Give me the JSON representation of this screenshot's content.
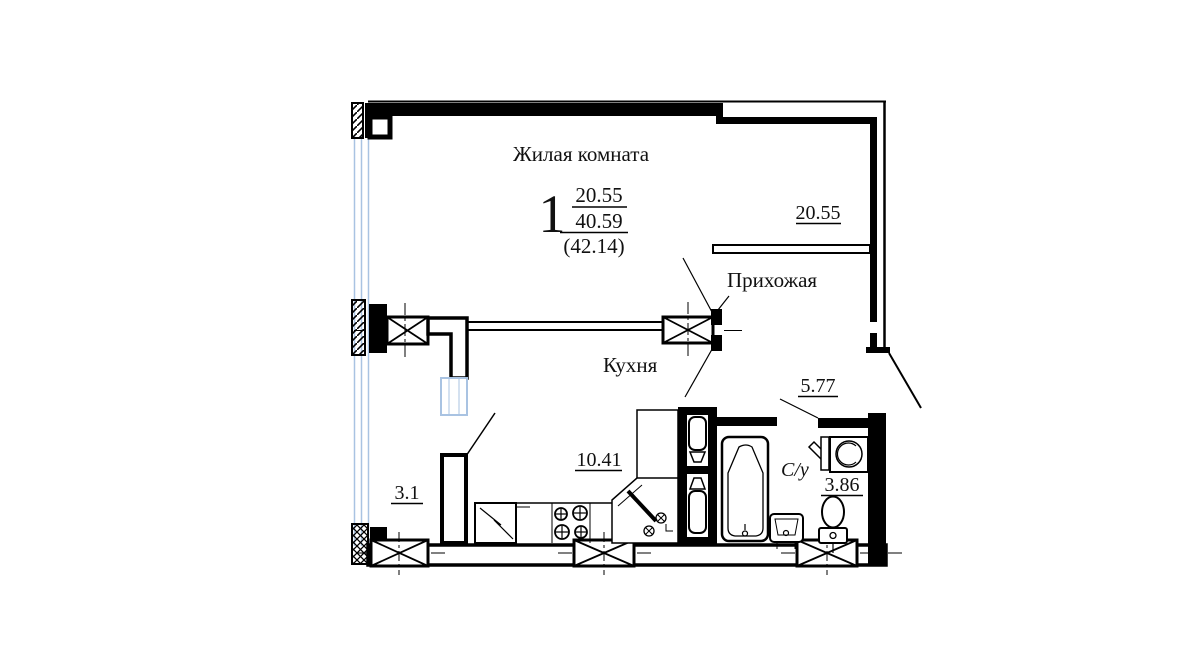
{
  "document": {
    "type": "apartment-floor-plan",
    "language": "ru"
  },
  "labels": {
    "living_room": "Жилая комната",
    "rooms_count": "1",
    "living_area": "20.55",
    "total_area": "40.59",
    "overall_area": "(42.14)",
    "hallway": "Прихожая",
    "hallway_area": "20.55",
    "kitchen": "Кухня",
    "kitchen_area": "10.41",
    "bathroom": "С/у",
    "bathroom_area": "3.86",
    "corridor_area": "5.77",
    "balcony_area": "3.1"
  },
  "colors": {
    "line": "#000000",
    "glazing": "#a9c3e2",
    "background": "#ffffff",
    "text": "#111111"
  }
}
